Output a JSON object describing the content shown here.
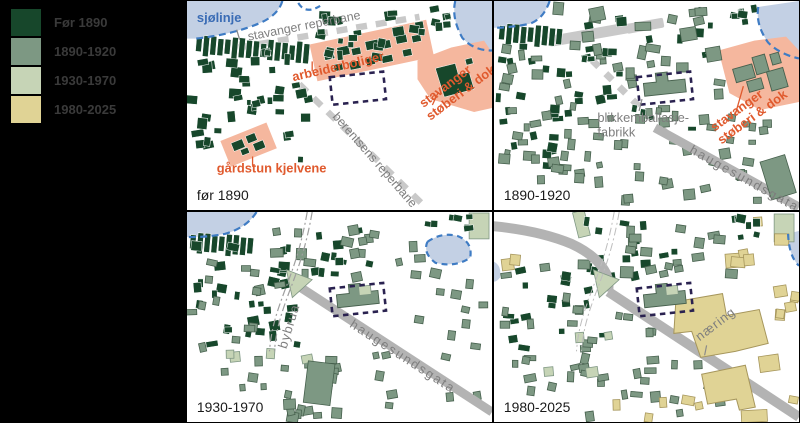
{
  "legend": {
    "items": [
      {
        "label": "Før 1890",
        "color": "#17472b"
      },
      {
        "label": "1890-1920",
        "color": "#7d9883"
      },
      {
        "label": "1930-1970",
        "color": "#c6d4b6"
      },
      {
        "label": "1980-2025",
        "color": "#e0d395"
      }
    ]
  },
  "colors": {
    "background": "#000000",
    "map_background": "#ffffff",
    "water": "#c3d0e4",
    "coastline_dash": "#3f7cc4",
    "highlight_area": "#f5b79e",
    "annotation_orange": "#e05a2e",
    "road_gray": "#b3b3b3",
    "ropewalk_dash_gray": "#c9c9c9",
    "plan_outline_navy": "#2a2250",
    "label_gray": "#7e7e7e",
    "label_blue": "#3a6cb5",
    "caption_black": "#1a1a1a"
  },
  "panels": [
    {
      "id": "before-1890",
      "caption": "før 1890",
      "labels": {
        "shoreline": "sjølinje",
        "ropewalk_top": "stavanger reperbane",
        "ropewalk_diagonal": "berentsens reperbane",
        "workers_housing": "arbeiderboliger",
        "foundry_line1": "stavanger",
        "foundry_line2": "støberi & dok",
        "farmstead": "gårdstun kjelvene"
      }
    },
    {
      "id": "1890-1920",
      "caption": "1890-1920",
      "labels": {
        "factory_line1": "blikkemballasje-",
        "factory_line2": "fabrikk",
        "foundry_line1": "stavanger",
        "foundry_line2": "støberi & dok",
        "street": "haugesundsgata"
      }
    },
    {
      "id": "1930-1970",
      "caption": "1930-1970",
      "labels": {
        "bridge": "bybrua",
        "street": "haugesundsgata"
      }
    },
    {
      "id": "1980-2025",
      "caption": "1980-2025",
      "labels": {
        "business": "næring"
      }
    }
  ]
}
